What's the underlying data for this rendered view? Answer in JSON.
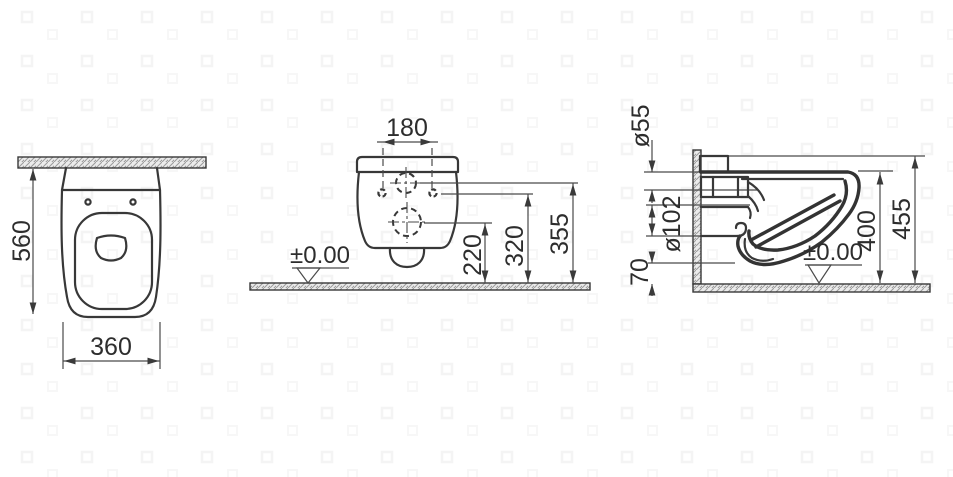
{
  "views": {
    "top_view": {
      "depth": "560",
      "width": "360"
    },
    "rear_view": {
      "bolt_spacing": "180",
      "floor_level": "±0.00",
      "outlet_height": "220",
      "bolt_height": "320",
      "inlet_height": "355"
    },
    "side_view": {
      "inlet_diameter": "ø55",
      "outlet_diameter": "ø102",
      "clearance": "70",
      "rim_height": "400",
      "overall_height": "455",
      "floor_level": "±0.00"
    }
  },
  "colors": {
    "line": "#383838",
    "dimension_line": "#4a4a4a",
    "text": "#2d2d2d",
    "hatch_fill": "#ebebeb",
    "hatch_stroke": "#9a9a9a",
    "background": "#ffffff",
    "watermark": "#f4f4f4"
  }
}
